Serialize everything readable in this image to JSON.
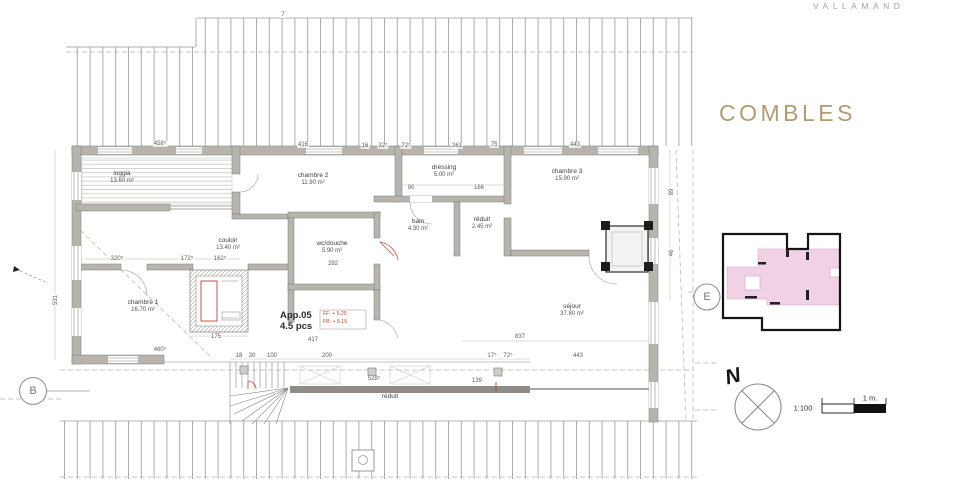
{
  "header": {
    "project": "VALLAMAND",
    "sheet_title": "COMBLES"
  },
  "plan": {
    "apartment": {
      "id": "App.05",
      "rooms_count": "4.5 pcs",
      "level_ff": "FF: + 5.25",
      "level_fb": "FB: + 5.15"
    },
    "rooms": [
      {
        "name": "loggia",
        "area": "13.60 m²",
        "x": 122,
        "y": 178
      },
      {
        "name": "chambre 2",
        "area": "11.90 m²",
        "x": 313,
        "y": 180
      },
      {
        "name": "dressing",
        "area": "5.00 m²",
        "x": 444,
        "y": 172
      },
      {
        "name": "chambre 3",
        "area": "15.90 m²",
        "x": 567,
        "y": 176
      },
      {
        "name": "bain",
        "area": "4.30 m²",
        "x": 418,
        "y": 226
      },
      {
        "name": "réduit",
        "area": "2.45 m²",
        "x": 482,
        "y": 224
      },
      {
        "name": "wc/douche",
        "area": "5.90 m²",
        "x": 332,
        "y": 248
      },
      {
        "name": "couloir",
        "area": "13.40 m²",
        "x": 228,
        "y": 245
      },
      {
        "name": "chambre 1",
        "area": "16.70 m²",
        "x": 143,
        "y": 307
      },
      {
        "name": "séjour",
        "area": "37.80 m²",
        "x": 572,
        "y": 311
      },
      {
        "name": "réduit",
        "area": "",
        "x": 390,
        "y": 397
      }
    ],
    "dimensions": [
      {
        "t": "458⁵",
        "x": 160,
        "y": 144
      },
      {
        "t": "416",
        "x": 303,
        "y": 145
      },
      {
        "t": "16",
        "x": 365,
        "y": 146
      },
      {
        "t": "32⁵",
        "x": 383,
        "y": 146
      },
      {
        "t": "72⁵",
        "x": 406,
        "y": 146
      },
      {
        "t": "261",
        "x": 457,
        "y": 146
      },
      {
        "t": "75",
        "x": 494,
        "y": 145
      },
      {
        "t": "443",
        "x": 575,
        "y": 145
      },
      {
        "t": "7",
        "x": 283,
        "y": 15
      },
      {
        "t": "90",
        "x": 411,
        "y": 188
      },
      {
        "t": "166",
        "x": 479,
        "y": 188
      },
      {
        "t": "282",
        "x": 333,
        "y": 264
      },
      {
        "t": "320⁵",
        "x": 117,
        "y": 259
      },
      {
        "t": "172⁵",
        "x": 187,
        "y": 259
      },
      {
        "t": "162⁵",
        "x": 220,
        "y": 259
      },
      {
        "t": "531",
        "x": 56,
        "y": 300,
        "r": 1
      },
      {
        "t": "175",
        "x": 216,
        "y": 337
      },
      {
        "t": "460⁵",
        "x": 160,
        "y": 350
      },
      {
        "t": "18",
        "x": 239,
        "y": 356
      },
      {
        "t": "30",
        "x": 252,
        "y": 356
      },
      {
        "t": "100",
        "x": 272,
        "y": 356
      },
      {
        "t": "200",
        "x": 327,
        "y": 356
      },
      {
        "t": "528⁵",
        "x": 374,
        "y": 379
      },
      {
        "t": "139",
        "x": 477,
        "y": 381
      },
      {
        "t": "17⁵",
        "x": 492,
        "y": 356
      },
      {
        "t": "72⁵",
        "x": 508,
        "y": 356
      },
      {
        "t": "443",
        "x": 578,
        "y": 356
      },
      {
        "t": "837",
        "x": 520,
        "y": 337
      },
      {
        "t": "417",
        "x": 313,
        "y": 340
      },
      {
        "t": "89",
        "x": 672,
        "y": 192,
        "r": 1
      },
      {
        "t": "46",
        "x": 672,
        "y": 253,
        "r": 1
      }
    ],
    "markers": {
      "section_b": "B",
      "section_e": "E",
      "north": "N"
    }
  },
  "legend": {
    "scale_ratio": "1:100",
    "scale_unit": "1 m."
  },
  "colors": {
    "accent_title": "#b49b71",
    "keyplan_highlight": "#f1d2e4",
    "annotation_red": "#c0443a"
  }
}
